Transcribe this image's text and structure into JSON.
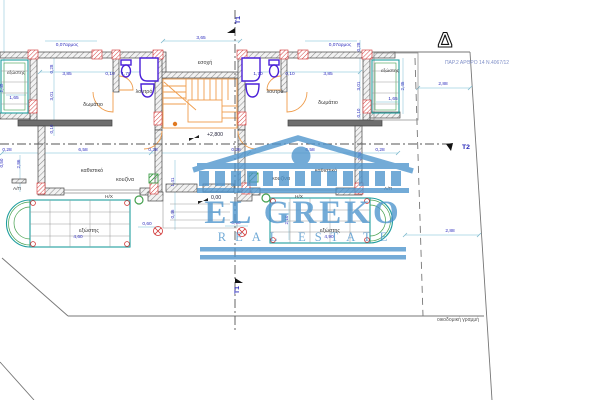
{
  "watermark": {
    "name": "EL GREKO",
    "tagline": "REAL ESTATE"
  },
  "markers": {
    "t1": "Τ1",
    "t2": "Τ2",
    "delta": "Δ"
  },
  "notes": {
    "regulation": "ΠΑΡ.2 ΑΡΘΡΟ 14 Ν.4067/12",
    "building_line": "οικοδομική γραμμή"
  },
  "levels": {
    "upper": "+2,800",
    "zero": "0,00"
  },
  "rooms": {
    "core": {
      "recess": "εσοχή"
    },
    "left": {
      "balcony_top": "εξώστης",
      "bedroom": "δωμάτιο",
      "bathroom": "λουτρό",
      "living": "καθιστικό",
      "kitchen": "κουζίνα",
      "hx": "Η/Χ",
      "ap": "Α/Π",
      "balcony_bottom": "εξώστης"
    },
    "right": {
      "balcony_top": "εξώστης",
      "bedroom": "δωμάτιο",
      "bathroom": "λουτρό",
      "living": "καθιστικό",
      "kitchen": "κουζίνα",
      "hx": "Η/Χ",
      "ap": "Α/Π",
      "balcony_bottom": "εξώστης"
    }
  },
  "dims": {
    "joint_left": "0,07αρμος",
    "joint_right": "0,07αρμος",
    "recess_width": "3,65",
    "v028_left": "0,28",
    "v028_right": "0,28",
    "bed_l_width": "3,85",
    "gap_l": "0,10",
    "bath_l_width": "1,70",
    "bath_r_width": "1,70",
    "gap_r": "0,10",
    "bed_r_width": "3,85",
    "balc_tl_depth": "2,45",
    "balc_tl_width": "1,65",
    "balc_tr_depth": "2,45",
    "balc_tr_width": "1,65",
    "bed_l_depth": "3,01",
    "ledge_l": "0,10",
    "bed_r_depth": "3,01",
    "ledge_r": "0,10",
    "m028_a": "0,28",
    "liv_l_width": "6,58",
    "m028_b": "0,28",
    "m028_c": "0,28",
    "liv_r_width": "6,58",
    "m028_d": "0,28",
    "liv_l_depth": "2,86",
    "liv_r_depth": "2,86",
    "west_offset": "0,50",
    "core_a": "1,41",
    "core_b": "0,46",
    "core_c": "0,60",
    "core_d": "0,90",
    "balc_br_depth": "2,10",
    "balc_bl_width": "4,60",
    "balc_br_width": "4,90",
    "setback_top": "2,88",
    "setback_bottom": "2,88"
  },
  "colors": {
    "watermark_blue": "#4d94cc",
    "dimension_blue": "#2f2fbe",
    "dimension_line": "#9fd0e0",
    "wall_dark": "#3f3f3f",
    "column_red": "#d03030",
    "fixture_purple": "#4a20d8",
    "stair_orange": "#ef9d4d",
    "balcony_teal": "#1f9e9e",
    "balcony_green": "#44a04e"
  }
}
